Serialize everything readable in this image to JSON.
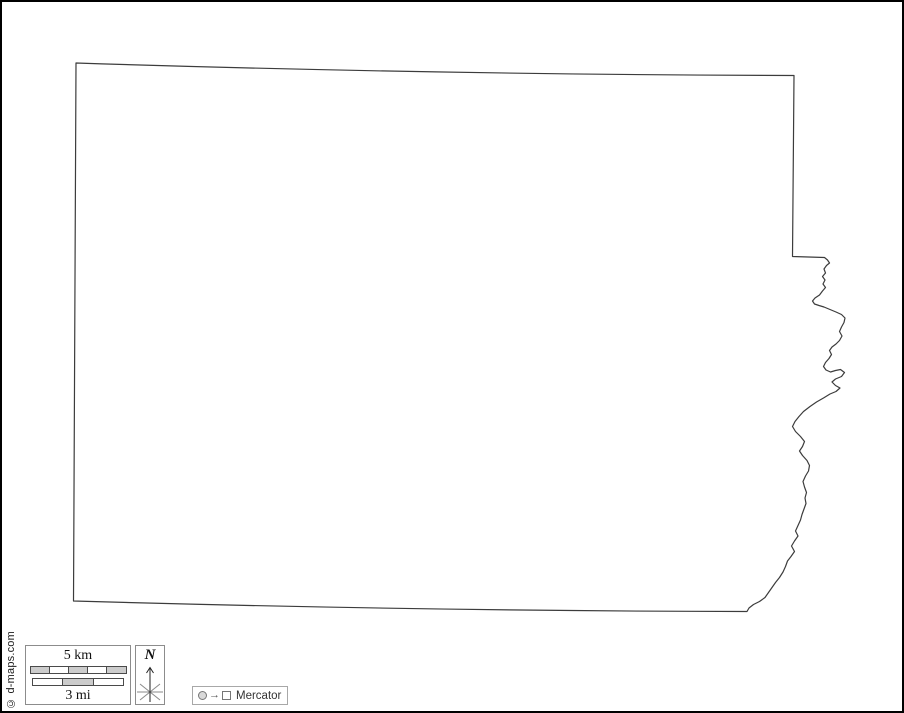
{
  "map": {
    "outline_path": "M 74,61 Q 430,72.5 792,73.5 L 790.5,254.5 L 822.5,255.5 L 825.5,258 L 827.5,261 L 824.5,263.5 L 822,267 L 823.5,271 L 820.5,274.5 L 823,278 L 821,282 L 823.5,285.5 L 820.5,289 L 817.5,293 L 813,296 L 810.5,299 L 812.5,302 L 817,303.5 L 822,305 L 828,307.5 L 834,310 L 839.5,312.5 L 843,316 L 842,320.5 L 839.5,325 L 837.5,329.5 L 840,334 L 837.5,338.5 L 834,342 L 830,345 L 827.5,348.5 L 829.5,352.5 L 827,356.5 L 823.5,360.5 L 821.5,364.5 L 824,368 L 828.5,370 L 833.5,368.5 L 838.5,367.5 L 842.5,370.5 L 839.5,374.5 L 833.5,377 L 830,380 L 833.5,383.5 L 838,386 L 834,389.5 L 828,392 L 821.5,396 L 814.5,400 L 808,404.5 L 801.5,409.5 L 797,414.5 L 793,419.5 L 790.5,424.5 L 793.5,429.5 L 798.5,434.5 L 802.5,439.5 L 800.5,444.5 L 797.5,449 L 800.5,453.5 L 805,458.5 L 807.5,463.5 L 806.5,469 L 803.5,474 L 801,479.5 L 802.5,485 L 804.5,490.5 L 803,496 L 804,501.5 L 802,507 L 800,512.5 L 798.5,518 L 796,523.5 L 793.5,529 L 796,534 L 792.5,539 L 789.5,544 L 792.5,549.5 L 789,554.5 L 785.5,559 L 783.5,564.5 L 781,570 L 777.5,575.5 L 773.5,580.5 L 770,585.5 L 766.5,590.5 L 763,595.5 L 757.5,599.5 L 751.5,602.5 L 747,606 L 745,609.5 Q 420,609 71.5,599 Z",
    "outline_color": "#3c3c3c",
    "region_fill": "#ffffff"
  },
  "scale_bar": {
    "km_label": "5 km",
    "mi_label": "3 mi",
    "segment_fill": "#cccccc"
  },
  "compass": {
    "label": "N"
  },
  "projection_legend": {
    "arrow": "→",
    "label": "Mercator"
  },
  "credit": "© d-maps.com",
  "colors": {
    "page_border": "#000000",
    "box_border": "#8c8c8c",
    "background": "#ffffff"
  }
}
